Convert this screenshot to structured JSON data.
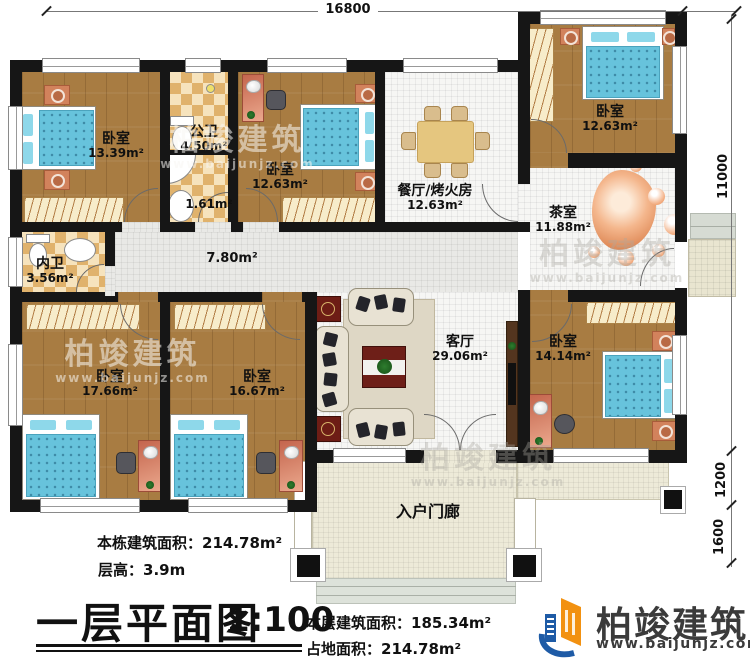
{
  "dims": {
    "top": "16800",
    "right_upper": "11000",
    "right_mid": "1200",
    "right_lower": "1600"
  },
  "rooms": {
    "bedroom_tl": {
      "name": "卧室",
      "area": "13.39m²"
    },
    "bath_public": {
      "name": "公卫",
      "area": "4.50m²"
    },
    "wash_small": {
      "area": "1.61m²"
    },
    "bedroom_tm": {
      "name": "卧室",
      "area": "12.63m²"
    },
    "dining": {
      "name": "餐厅/烤火房",
      "area": "12.63m²"
    },
    "bedroom_tr": {
      "name": "卧室",
      "area": "12.63m²"
    },
    "tea": {
      "name": "茶室",
      "area": "11.88m²"
    },
    "bath_inner": {
      "name": "内卫",
      "area": "3.56m²"
    },
    "hallway": {
      "area": "7.80m²"
    },
    "bedroom_bl": {
      "name": "卧室",
      "area": "17.66m²"
    },
    "bedroom_bm": {
      "name": "卧室",
      "area": "16.67m²"
    },
    "living": {
      "name": "客厅",
      "area": "29.06m²"
    },
    "bedroom_br": {
      "name": "卧室",
      "area": "14.14m²"
    },
    "porch": {
      "name": "入户门廊"
    }
  },
  "info": {
    "building_area_label": "本栋建筑面积：",
    "building_area_value": "214.78m²",
    "floor_height_label": "层高：",
    "floor_height_value": "3.9m",
    "title": "一层平面图",
    "scale": "1:100",
    "floor_area_label": "本层建筑面积：",
    "floor_area_value": "185.34m²",
    "footprint_label": "占地面积：",
    "footprint_value": "214.78m²"
  },
  "brand": {
    "name": "柏竣建筑",
    "url": "www.baijunjz.com"
  },
  "watermark": {
    "name": "柏竣建筑",
    "url": "www.baijunjz.com"
  }
}
